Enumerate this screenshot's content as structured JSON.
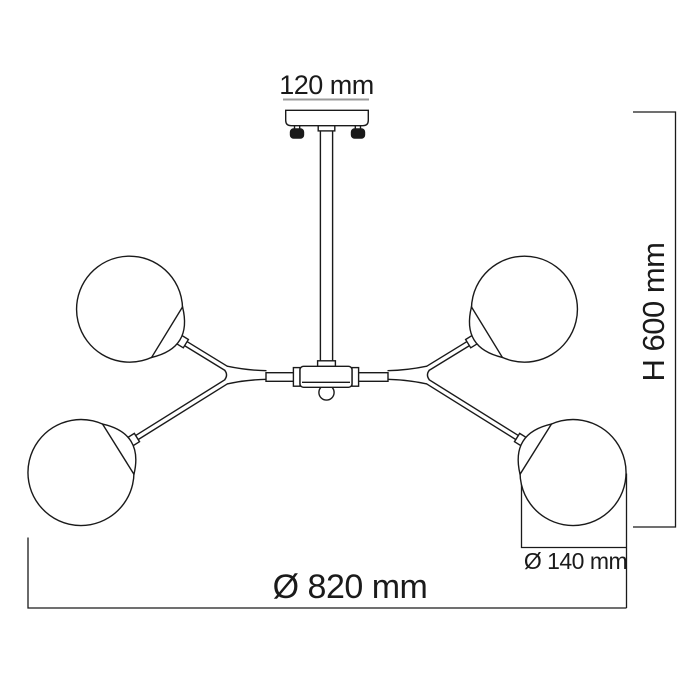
{
  "colors": {
    "line": "#1a1a1a",
    "dim_underline": "#9a9a9a",
    "background": "#ffffff"
  },
  "dimensions": {
    "canopy_width": "120 mm",
    "height": "H 600 mm",
    "total_diameter": "Ø 820 mm",
    "globe_diameter": "Ø 140 mm"
  }
}
